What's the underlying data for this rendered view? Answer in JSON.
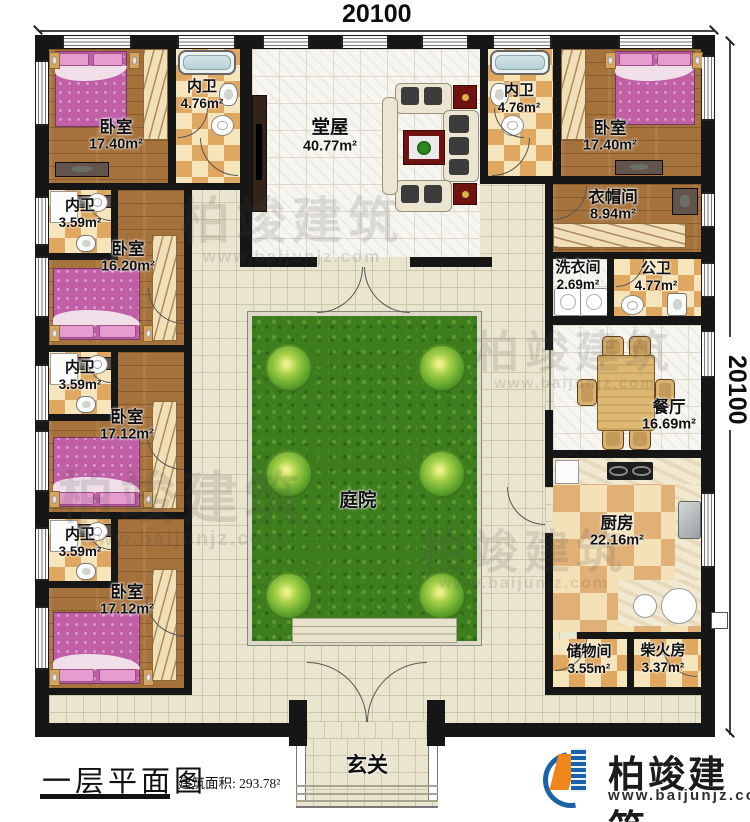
{
  "dimensions": {
    "top": "20100",
    "right": "20100"
  },
  "rooms": {
    "bedroom_tl": {
      "label": "卧室",
      "area": "17.40m²"
    },
    "bath_tl": {
      "label": "内卫",
      "area": "4.76m²"
    },
    "hall": {
      "label": "堂屋",
      "area": "40.77m²"
    },
    "bath_tr": {
      "label": "内卫",
      "area": "4.76m²"
    },
    "bedroom_tr": {
      "label": "卧室",
      "area": "17.40m²"
    },
    "bath_l2": {
      "label": "内卫",
      "area": "3.59m²"
    },
    "bedroom_l2": {
      "label": "卧室",
      "area": "16.20m²"
    },
    "bath_l3": {
      "label": "内卫",
      "area": "3.59m²"
    },
    "bedroom_l3": {
      "label": "卧室",
      "area": "17.12m²"
    },
    "bath_l4": {
      "label": "内卫",
      "area": "3.59m²"
    },
    "bedroom_l4": {
      "label": "卧室",
      "area": "17.12m²"
    },
    "cloakroom": {
      "label": "衣帽间",
      "area": "8.94m²"
    },
    "laundry": {
      "label": "洗衣间",
      "area": "2.69m²"
    },
    "public_bath": {
      "label": "公卫",
      "area": "4.77m²"
    },
    "dining": {
      "label": "餐厅",
      "area": "16.69m²"
    },
    "kitchen": {
      "label": "厨房",
      "area": "22.16m²"
    },
    "storage": {
      "label": "储物间",
      "area": "3.55m²"
    },
    "firewood": {
      "label": "柴火房",
      "area": "3.37m²"
    },
    "courtyard": {
      "label": "庭院"
    },
    "foyer": {
      "label": "玄关"
    }
  },
  "footer": {
    "title": "一层平面图",
    "area_label": "建筑面积:",
    "area_value": "293.78²"
  },
  "brand": {
    "name": "柏竣建筑",
    "url": "www.baijunjz.com"
  },
  "watermark": {
    "name": "柏竣建筑",
    "url": "www.baijunjz.com"
  },
  "colors": {
    "wall": "#161616",
    "wood_floor": "#a6723c",
    "corridor_tile": "#eae5cf",
    "white_tile": "#f6f5ef",
    "bath_checker": "#dfa75f",
    "kitchen_checker": "#e0b077",
    "grass": "#3e7d1e",
    "bed_pink": "#c05ea6",
    "brand_blue": "#1b63a8",
    "brand_orange": "#f08519"
  }
}
